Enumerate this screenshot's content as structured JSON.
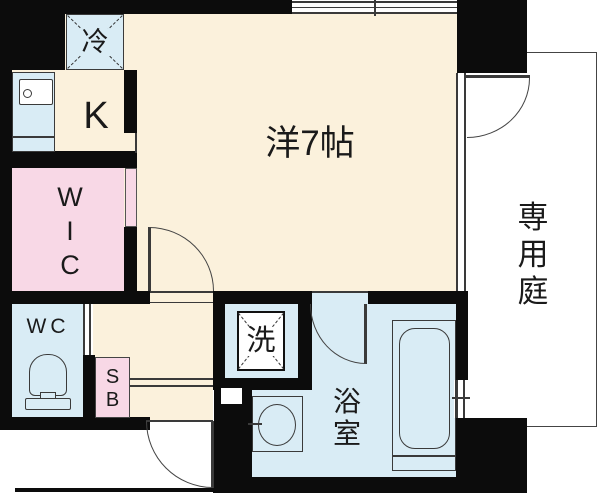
{
  "rooms": {
    "refrigerator": {
      "label": "冷"
    },
    "kitchen": {
      "label": "K"
    },
    "walk_in_closet": {
      "l1": "W",
      "l2": "I",
      "l3": "C"
    },
    "toilet": {
      "label": "WC"
    },
    "shoe_box": {
      "l1": "S",
      "l2": "B"
    },
    "main_room": {
      "label": "洋7帖"
    },
    "washer": {
      "label": "洗"
    },
    "bathroom": {
      "l1": "浴",
      "l2": "室"
    },
    "private_garden": {
      "l1": "専",
      "l2": "用",
      "l3": "庭"
    }
  },
  "colors": {
    "floor_cream": "#fbf1dc",
    "closet_pink": "#f8d8e6",
    "wet_blue": "#d9ecf5",
    "wall_black": "#0c0c0c",
    "line_gray": "#3a3a3a"
  }
}
